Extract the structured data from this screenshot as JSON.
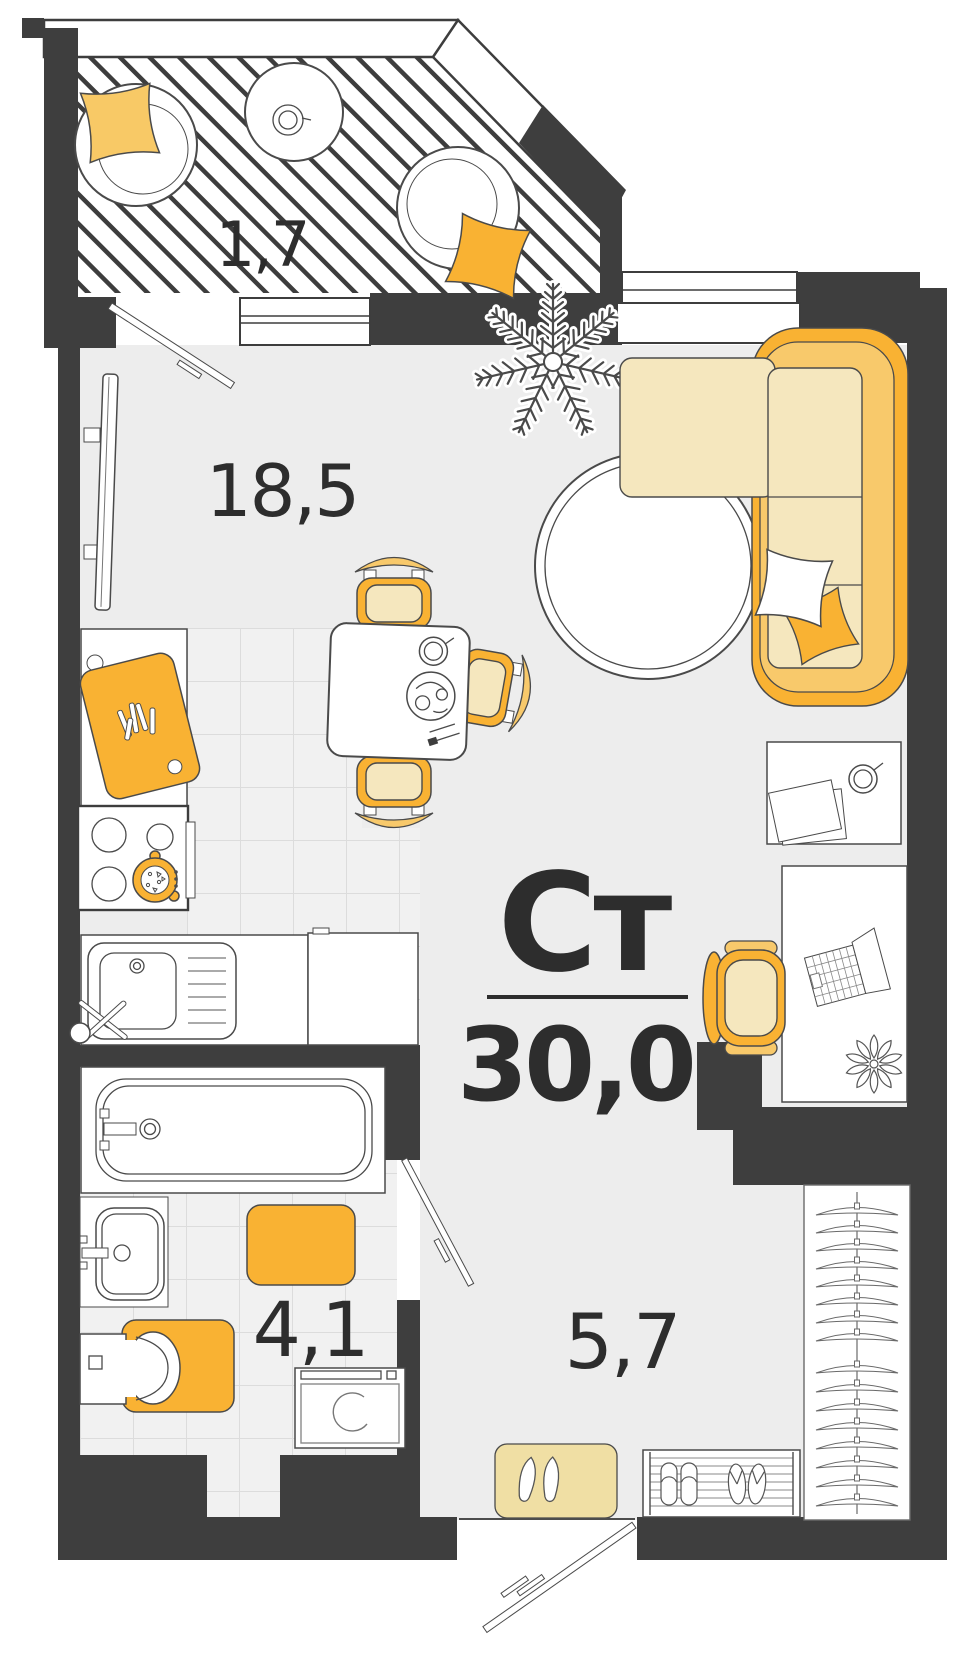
{
  "plan": {
    "type": "floor-plan",
    "title": "Ст",
    "total_area": "30,0",
    "rooms": [
      {
        "id": "balcony",
        "area": "1,7"
      },
      {
        "id": "living-kitchen",
        "area": "18,5"
      },
      {
        "id": "bathroom",
        "area": "4,1"
      },
      {
        "id": "hallway",
        "area": "5,7"
      }
    ]
  },
  "colors": {
    "wall": "#3E3E3E",
    "line": "#4a4a4a",
    "ink": "#2D2D2D",
    "accent": "#F9B233",
    "accent2": "#F8C96B",
    "cushion": "#F5E7BE",
    "mat": "#F0DFA4",
    "palepillow": "#F8C966",
    "floor": "#EDEDED",
    "tile": "#F1F1F1",
    "tileline": "#DCDCDC"
  }
}
